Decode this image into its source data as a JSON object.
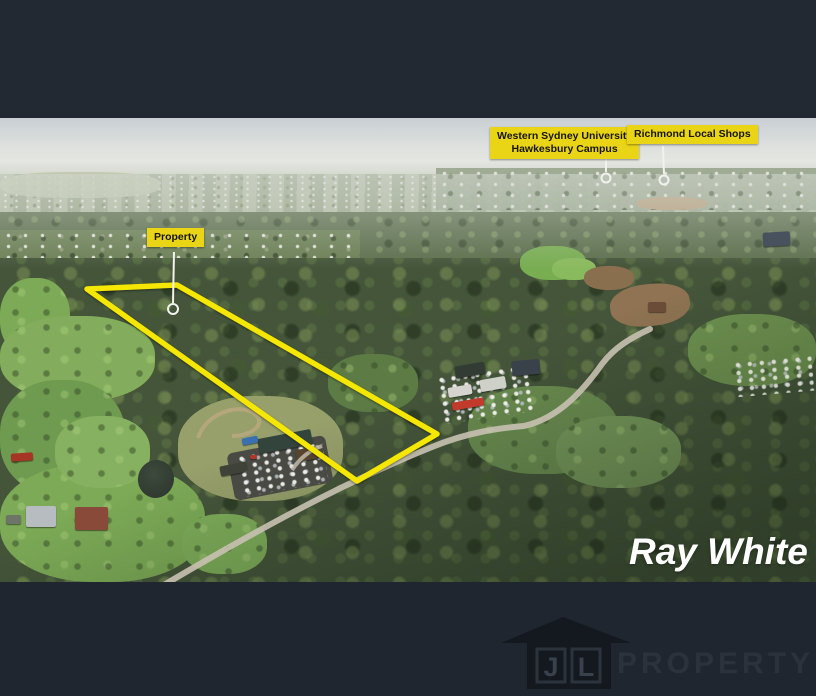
{
  "labels": {
    "property": "Property",
    "university_line1": "Western Sydney University",
    "university_line2": "Hawkesbury Campus",
    "shops": "Richmond Local Shops"
  },
  "branding": {
    "agency": "Ray White",
    "developer_wordmark": "PROPERTY",
    "developer_initials": [
      "J",
      "L"
    ]
  },
  "colors": {
    "top_bar": "#232932",
    "bottom_bar": "#20262f",
    "label_bg": "#e9d516",
    "label_text": "#16140d",
    "boundary": "#f6e700",
    "leader": "#f2f2ee",
    "marker": "#f2f2ee",
    "road": "#c8c1b1",
    "driveway": "#b9a87f",
    "ray_white_text": "#ffffff",
    "jl_icon": "#14181f",
    "jl_box": "#2c333d",
    "jl_letter": "#39414c",
    "jl_wordmark": "#2c323c"
  }
}
